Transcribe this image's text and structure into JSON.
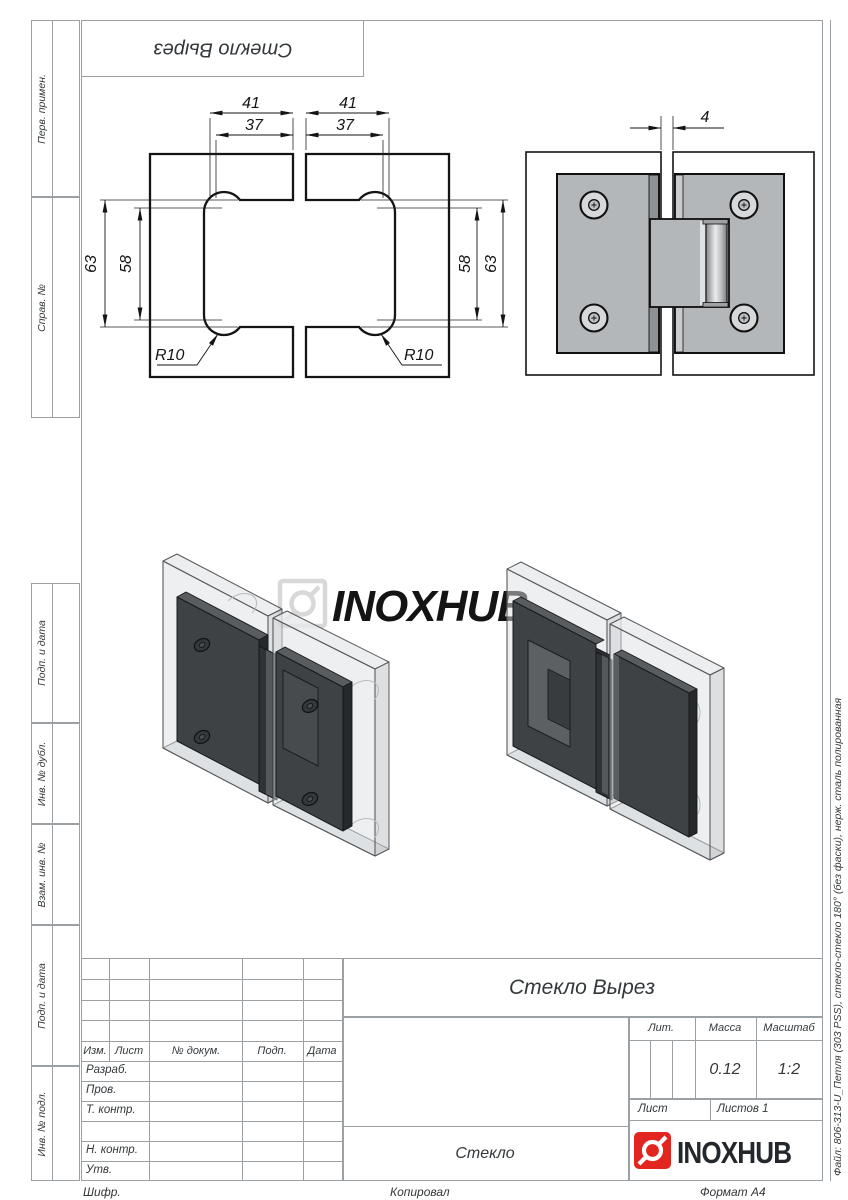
{
  "stamp_top": {
    "title": "Стекло Вырез"
  },
  "margin_labels": [
    "Перв. примен.",
    "Справ. №",
    "Подп. и дата",
    "Инв. № дубл.",
    "Взам. инв. №",
    "Подп. и дата",
    "Инв. № подл."
  ],
  "watermark": {
    "text": "INOXHUB"
  },
  "drawing": {
    "dim_41": "41",
    "dim_37": "37",
    "dim_63": "63",
    "dim_58": "58",
    "radius": "R10",
    "dim_gap": "4"
  },
  "title_block": {
    "title": "Стекло Вырез",
    "material": "Стекло",
    "header": {
      "izm": "Изм.",
      "list": "Лист",
      "dokum": "№ докум.",
      "podp": "Подп.",
      "data": "Дата"
    },
    "rows": {
      "razrab": "Разраб.",
      "prov": "Пров.",
      "t_kontr": "Т. контр.",
      "n_kontr": "Н. контр.",
      "utv": "Утв."
    },
    "lit_label": "Лит.",
    "mass_label": "Масса",
    "scale_label": "Масштаб",
    "mass_value": "0.12",
    "scale_value": "1:2",
    "list_label": "Лист",
    "listov_label": "Листов 1",
    "logo_text": "INOXHUB"
  },
  "footer": {
    "shifr": "Шифр.",
    "kopiroval": "Копировал",
    "format": "Формат A4"
  },
  "side_note": "Файл: 806-313-U_Петля (303 PSS), стекло-стекло 180° (без фаски), нерж. сталь полированная"
}
